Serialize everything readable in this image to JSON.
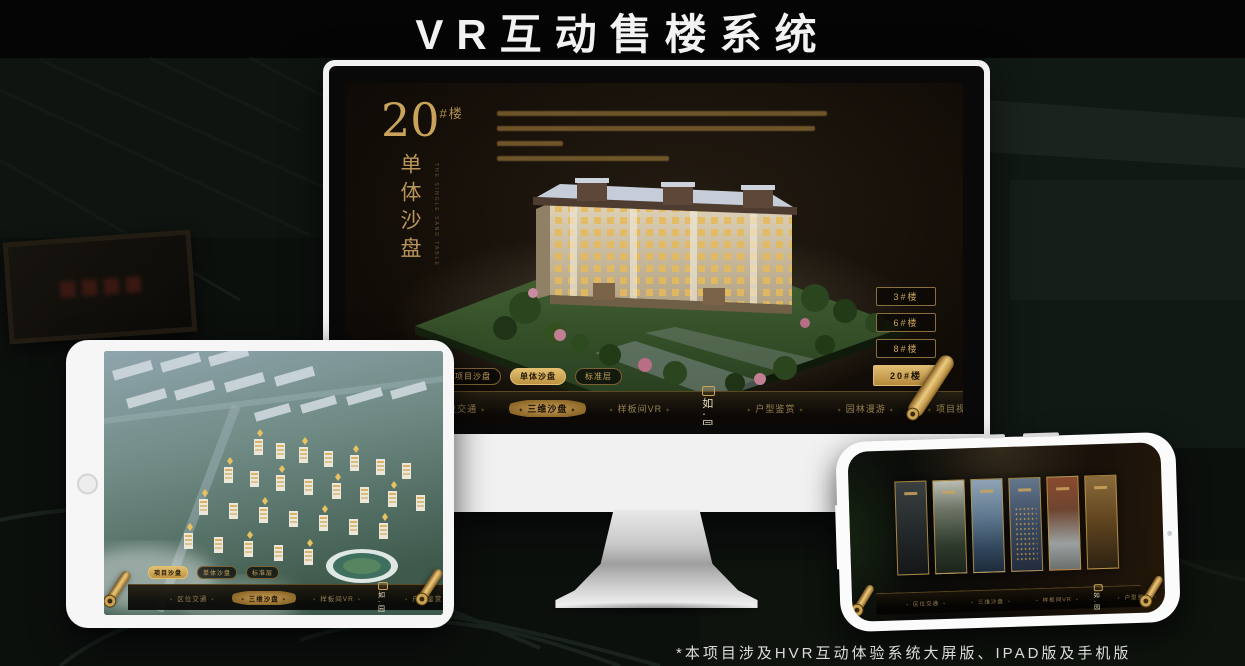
{
  "page": {
    "title": "VR互动售楼系统",
    "footnote": "*本项目涉及HVR互动体验系统大屏版、IPAD版及手机版"
  },
  "brand": {
    "logo_name": "如·园",
    "accent_gold": "#c9a359",
    "active_gold": "#d8b266",
    "screen_bg": "#140e08"
  },
  "nav": {
    "items": [
      "区位交通",
      "三维沙盘",
      "样板间VR",
      "户型鉴赏",
      "园林漫游",
      "项目视频"
    ]
  },
  "monitor": {
    "building_no": "20",
    "building_no_suffix": "#楼",
    "subtitle_cn": "单体沙盘",
    "subtitle_en": "THE SINGLE SAND TABLE",
    "floor_buttons": [
      "3#楼",
      "6#楼",
      "8#楼",
      "20#楼"
    ],
    "active_floor": "20#楼",
    "view_tabs": [
      "项目沙盘",
      "单体沙盘",
      "标准层"
    ],
    "active_view_tab": "单体沙盘",
    "active_nav_item": "三维沙盘"
  },
  "tablet": {
    "view_tabs": [
      "项目沙盘",
      "单体沙盘",
      "标准层"
    ],
    "active_view_tab": "项目沙盘",
    "active_nav_item": "三维沙盘"
  },
  "phone": {
    "active_nav_item": "园林漫游",
    "gallery_panel_count": 6
  }
}
